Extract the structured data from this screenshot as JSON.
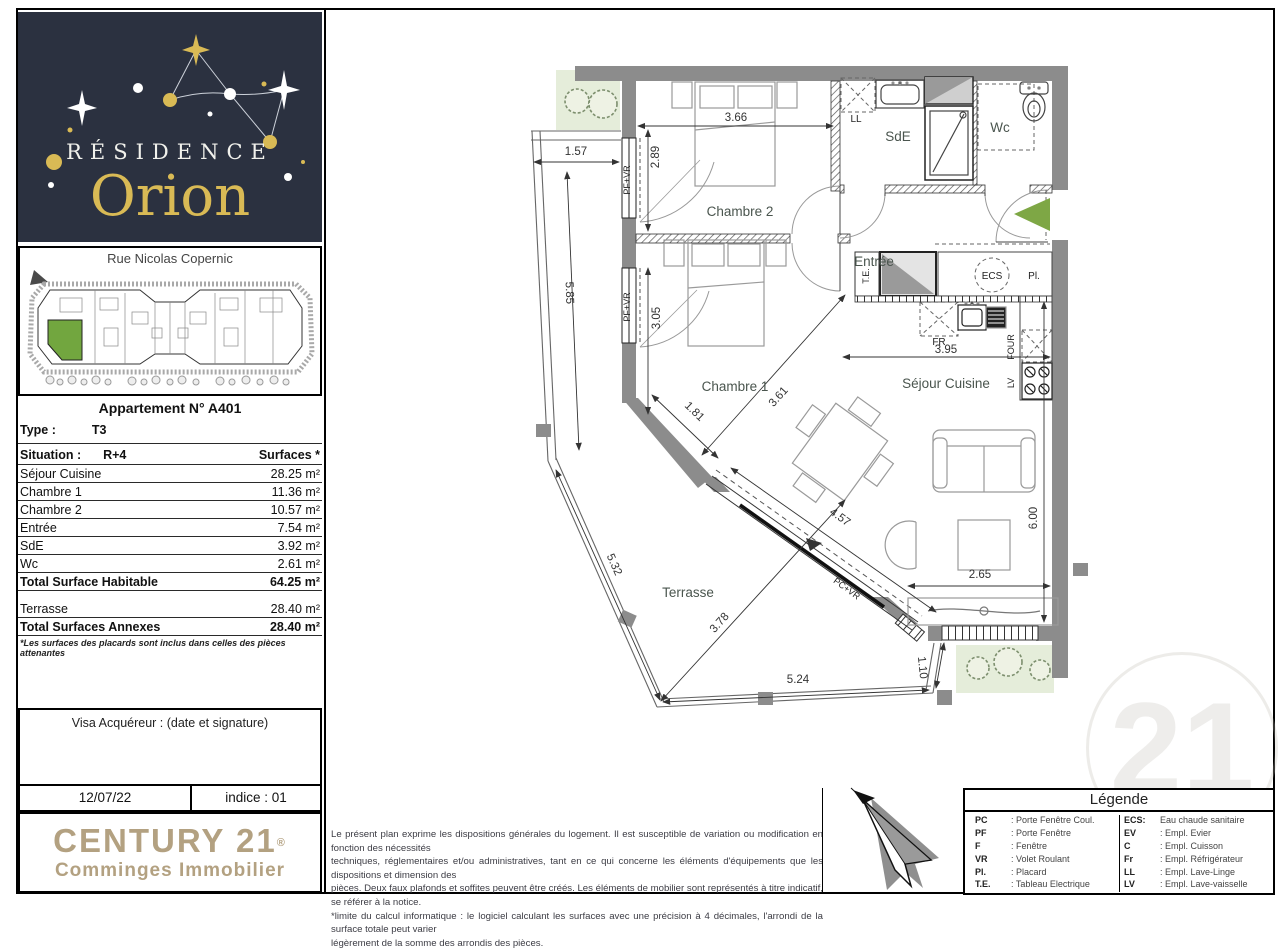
{
  "colors": {
    "navy": "#2b3140",
    "gold": "#d9ba55",
    "century_gold": "#b3a181",
    "arrow_green": "#7ea745",
    "vegetation_green": "#e5edda",
    "unit_green": "#72a63f",
    "wall_gray": "#8c8c8c"
  },
  "logo": {
    "residence": "RÉSIDENCE",
    "name": "Orion"
  },
  "site_plan": {
    "street": "Rue Nicolas Copernic"
  },
  "apartment": {
    "title": "Appartement N° A401",
    "type_label": "Type :",
    "type_value": "T3",
    "situation_label": "Situation :",
    "situation_value": "R+4",
    "surfaces_header": "Surfaces *",
    "rooms": [
      {
        "name": "Séjour Cuisine",
        "area": "28.25 m²"
      },
      {
        "name": "Chambre 1",
        "area": "11.36 m²"
      },
      {
        "name": "Chambre 2",
        "area": "10.57 m²"
      },
      {
        "name": "Entrée",
        "area": "7.54 m²"
      },
      {
        "name": "SdE",
        "area": "3.92 m²"
      },
      {
        "name": "Wc",
        "area": "2.61 m²"
      }
    ],
    "total_habitable_label": "Total Surface Habitable",
    "total_habitable_value": "64.25 m²",
    "terrasse_label": "Terrasse",
    "terrasse_value": "28.40 m²",
    "total_annexes_label": "Total Surfaces Annexes",
    "total_annexes_value": "28.40 m²",
    "footnote": "*Les surfaces des placards sont inclus dans celles des pièces attenantes"
  },
  "visa": {
    "title": "Visa Acquéreur : (date et signature)",
    "date": "12/07/22",
    "indice": "indice : 01"
  },
  "agency": {
    "brand": "CENTURY 21",
    "reg": "®",
    "subtitle": "Comminges Immobilier",
    "watermark": "21"
  },
  "disclaimer": {
    "lines": [
      "Le présent plan exprime les dispositions générales du logement. Il est susceptible de variation ou modification en fonction des nécessités",
      "techniques, réglementaires et/ou administratives, tant en ce qui concerne les éléments d'équipements que les dispositions et dimension des",
      "pièces. Deux faux plafonds et soffites peuvent être créés. Les éléments de mobilier sont représentés à titre indicatif, se référer à la notice.",
      "*limite du calcul informatique : le logiciel calculant les surfaces avec une précision à 4 décimales, l'arrondi de la surface totale peut varier",
      "légèrement de la somme des arrondis des pièces."
    ]
  },
  "legend": {
    "title": "Légende",
    "left": [
      {
        "abbr": "PC",
        "desc": ": Porte Fenêtre Coul."
      },
      {
        "abbr": "PF",
        "desc": ": Porte Fenêtre"
      },
      {
        "abbr": "F",
        "desc": ": Fenêtre"
      },
      {
        "abbr": "VR",
        "desc": ": Volet Roulant"
      },
      {
        "abbr": "Pl.",
        "desc": ": Placard"
      },
      {
        "abbr": "T.E.",
        "desc": ": Tableau Electrique"
      }
    ],
    "right": [
      {
        "abbr": "ECS:",
        "desc": "Eau chaude sanitaire"
      },
      {
        "abbr": "EV",
        "desc": ": Empl. Evier"
      },
      {
        "abbr": "C",
        "desc": ": Empl. Cuisson"
      },
      {
        "abbr": "Fr",
        "desc": ": Empl. Réfrigérateur"
      },
      {
        "abbr": "LL",
        "desc": ": Empl. Lave-Linge"
      },
      {
        "abbr": "LV",
        "desc": ": Empl. Lave-vaisselle"
      }
    ]
  },
  "plan": {
    "labels": {
      "chambre2": "Chambre 2",
      "chambre1": "Chambre 1",
      "entree": "Entrée",
      "sde": "SdE",
      "wc": "Wc",
      "sejour": "Séjour Cuisine",
      "terrasse": "Terrasse"
    },
    "tags": {
      "ll": "LL",
      "te": "T.E.",
      "ecs": "ECS",
      "pl": "Pl.",
      "fr": "FR",
      "four": "FOUR",
      "lv": "LV",
      "pfvr": "PF+VR",
      "pcvr": "PC+VR"
    },
    "dims": {
      "d_top": "1.57",
      "d_left": "5.85",
      "d_c2w": "3.66",
      "d_c2h": "2.89",
      "d_c1h": "3.05",
      "d_c1a": "1.81",
      "d_c1b": "3.61",
      "d_kitchen": "3.95",
      "d_slider": "4.57",
      "d_t1": "5.32",
      "d_t2": "3.78",
      "d_t3": "5.24",
      "d_t4": "1.10",
      "d_s1": "2.65",
      "d_s2": "6.00"
    }
  }
}
